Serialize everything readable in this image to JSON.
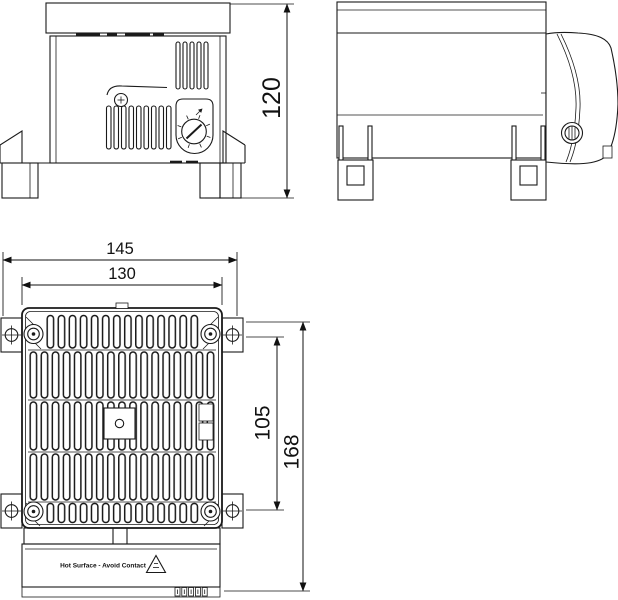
{
  "drawing": {
    "dimensions": {
      "side_height": "120",
      "front_width_overall": "145",
      "front_width_inner": "130",
      "front_hole_spacing": "105",
      "front_height_overall": "168"
    },
    "front_label": {
      "warning_text": "Hot Surface - Avoid Contact"
    },
    "colors": {
      "line": "#1a1a1a",
      "background": "#ffffff"
    }
  }
}
